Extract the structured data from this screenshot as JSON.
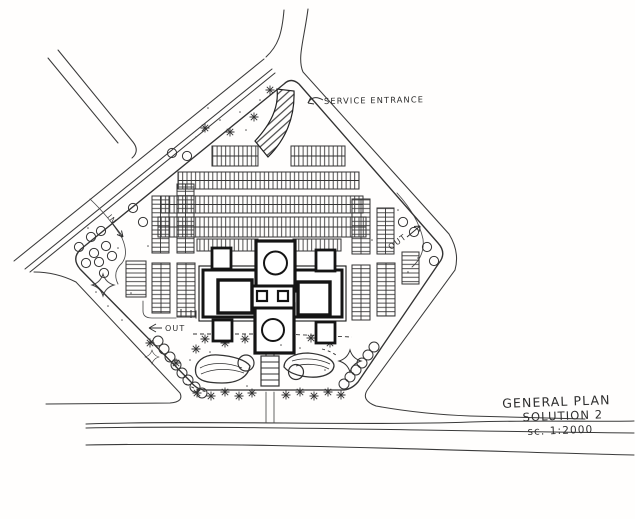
{
  "colors": {
    "paper": "#fffefd",
    "ink": "#2e2e2e",
    "ink_heavy": "#141414"
  },
  "drawing": {
    "labels": {
      "service_entrance": "SERVICE ENTRANCE",
      "out_right": "OUT",
      "out_left": "OUT",
      "entrance_in": "IN",
      "title_line1": "GENERAL PLAN",
      "title_line2": "SOLUTION 2",
      "title_line3": "sc. 1:2000"
    }
  }
}
